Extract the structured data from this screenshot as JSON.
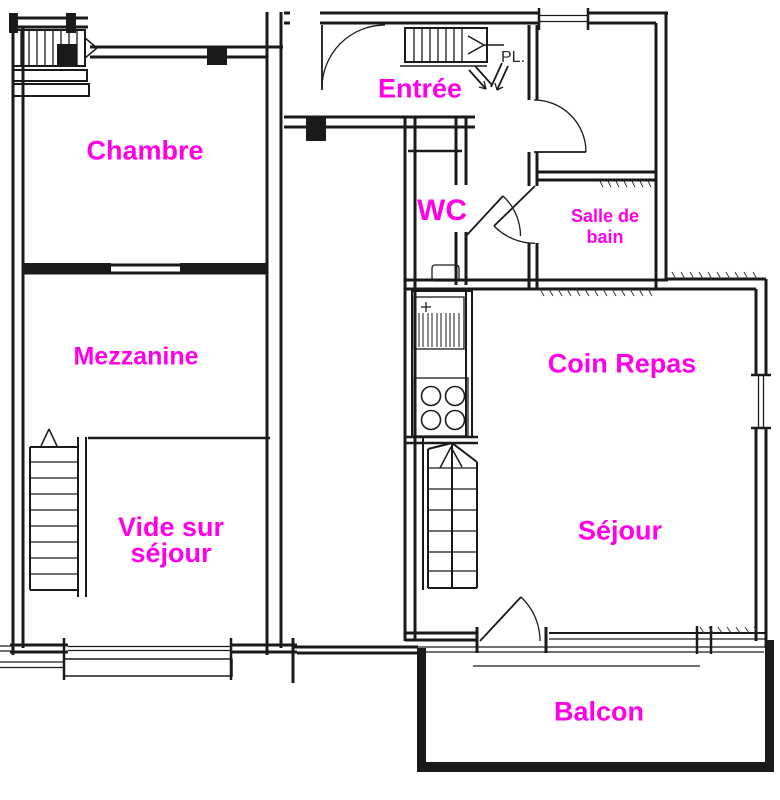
{
  "colors": {
    "label": "#ff00e6",
    "pl_label": "#2a2a2a",
    "wall": "#1a1a1a",
    "bg": "#ffffff"
  },
  "rooms": {
    "chambre": {
      "label": "Chambre"
    },
    "mezzanine": {
      "label": "Mezzanine"
    },
    "vide_sur_sejour": {
      "line1": "Vide sur",
      "line2": "séjour"
    },
    "entree": {
      "label": "Entrée"
    },
    "wc": {
      "label": "WC"
    },
    "salle_de_bain": {
      "line1": "Salle de",
      "line2": "bain"
    },
    "coin_repas": {
      "label": "Coin Repas"
    },
    "sejour": {
      "label": "Séjour"
    },
    "balcon": {
      "label": "Balcon"
    },
    "placard": {
      "label": "PL."
    }
  }
}
